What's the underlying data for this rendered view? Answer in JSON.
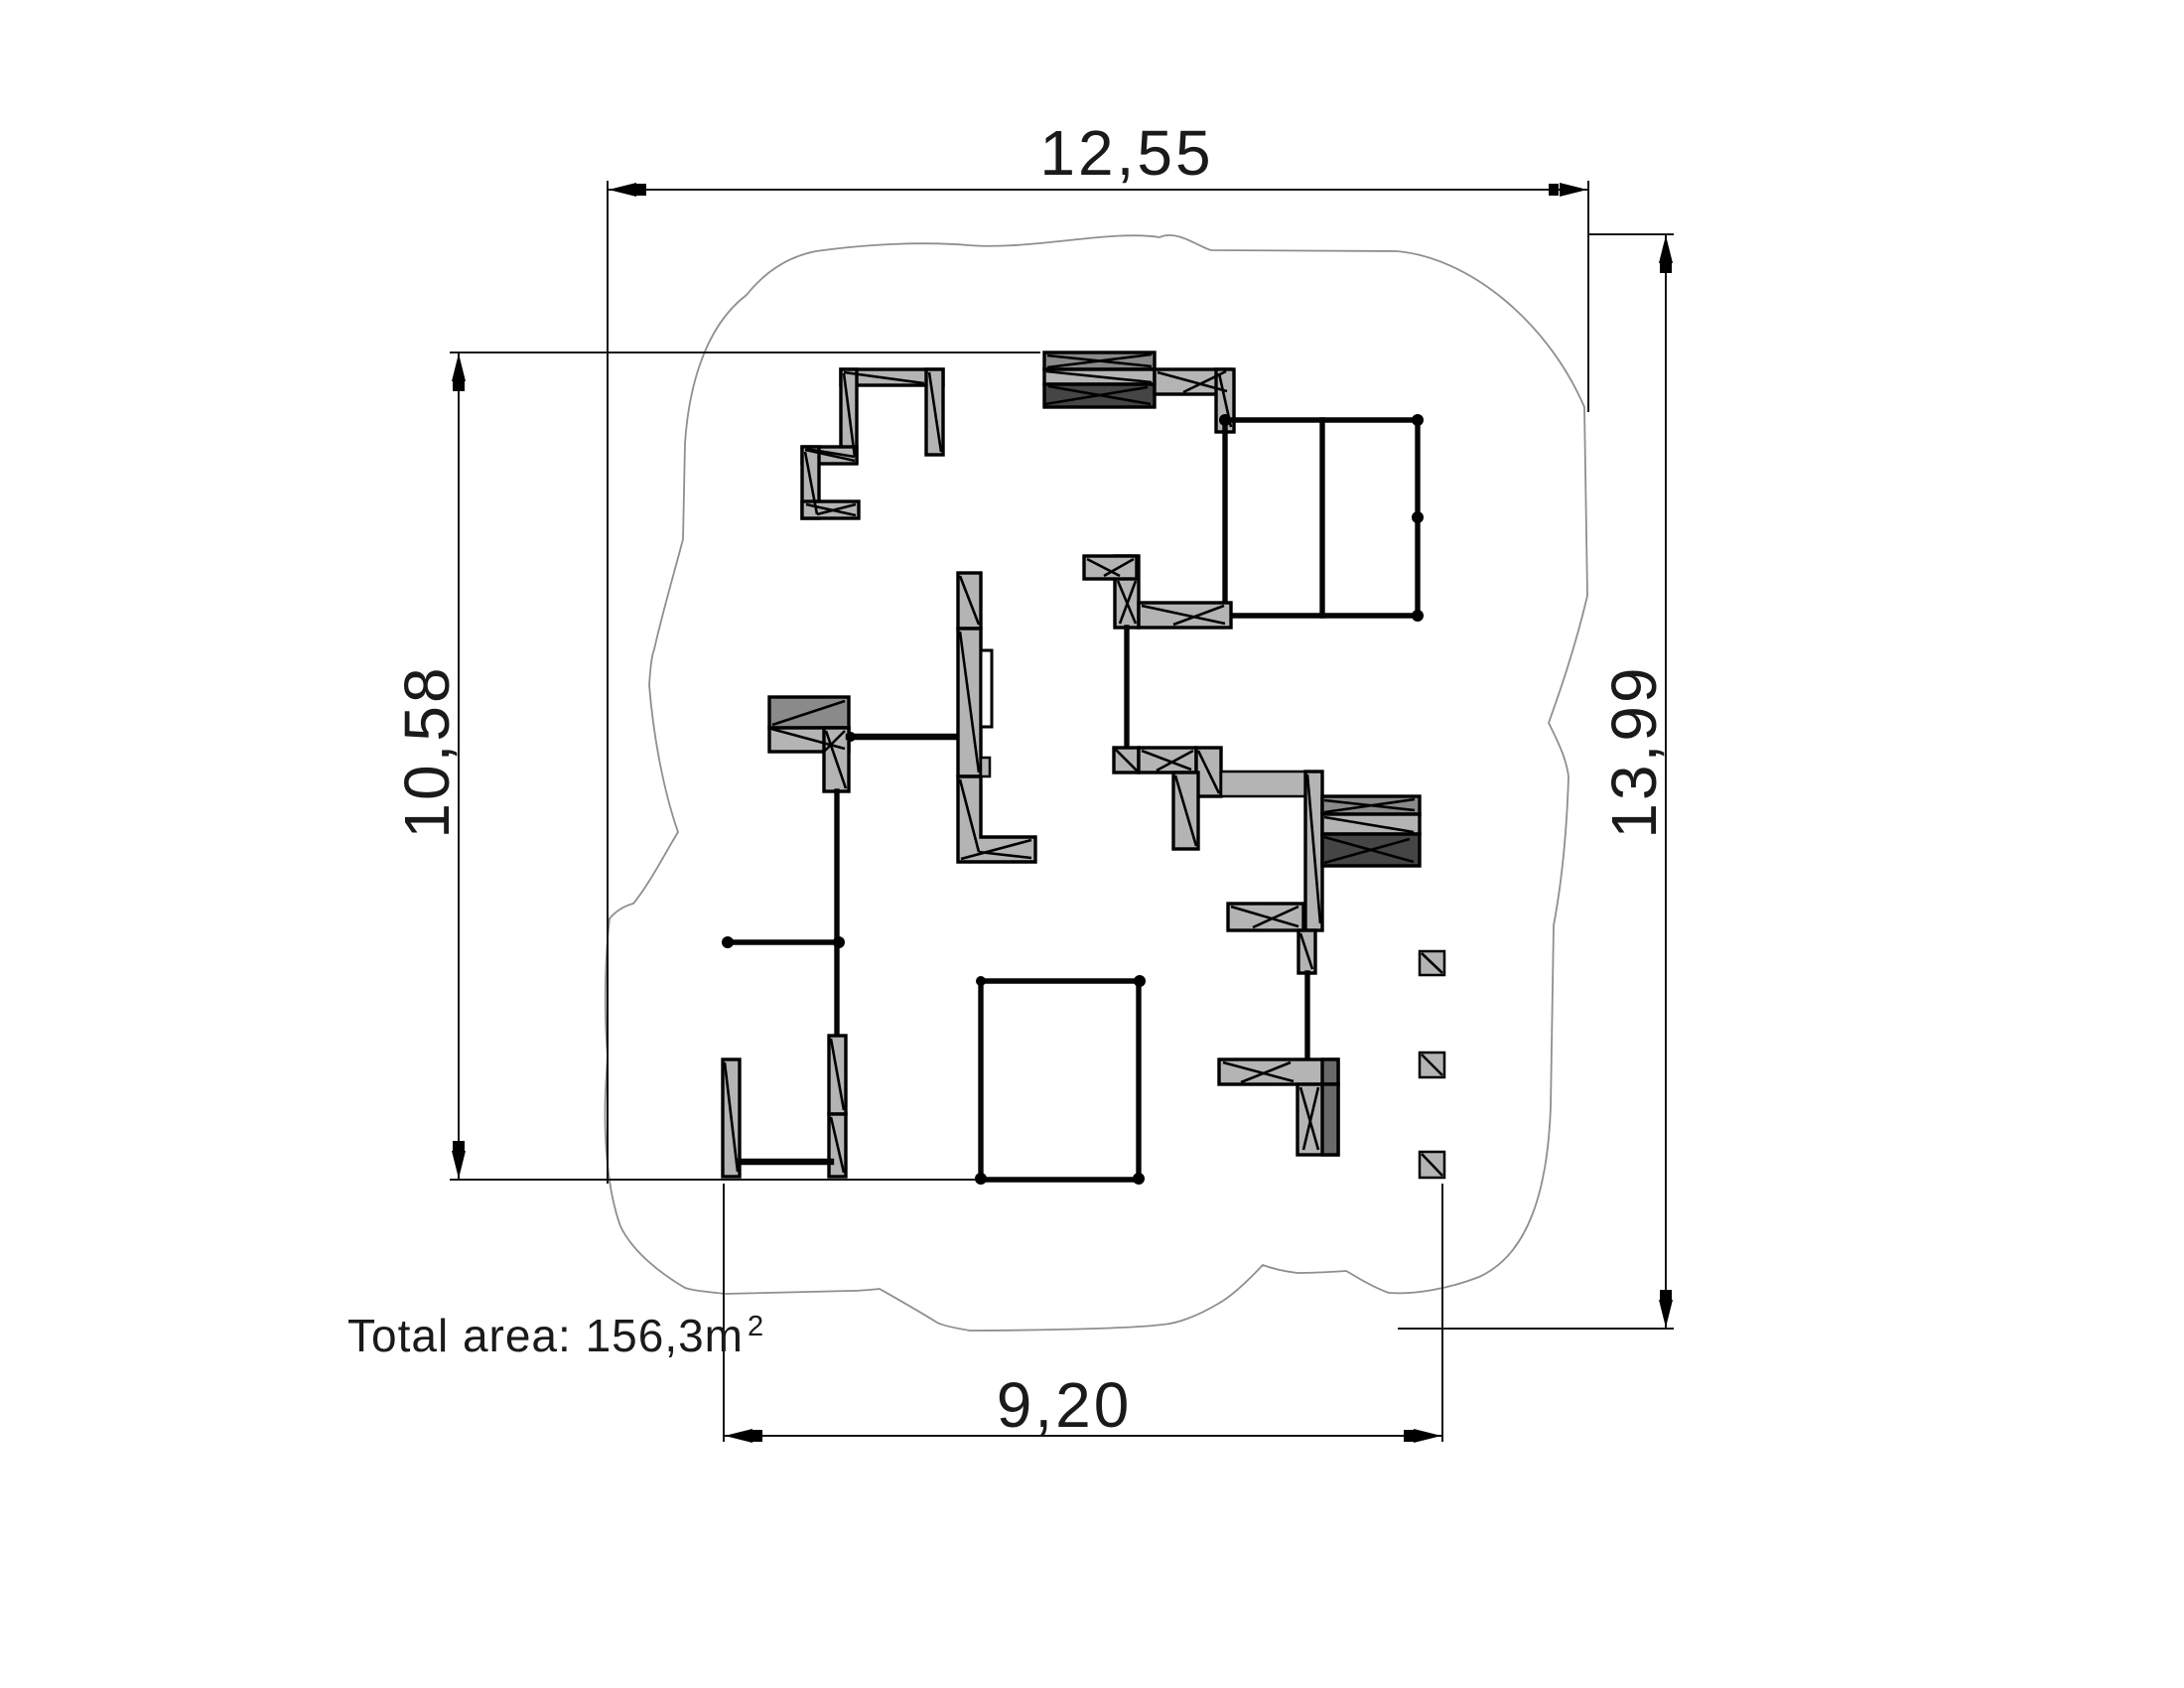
{
  "drawing": {
    "type": "floor-plan",
    "labels": {
      "dim_top": "12,55",
      "dim_left": "10,58",
      "dim_right": "13,99",
      "dim_bottom": "9,20",
      "total_area_prefix": "Total area: 156,3m",
      "total_area_exponent": "2"
    },
    "dimensions_meters": {
      "top_width": "12,55",
      "left_height": "10,58",
      "right_height": "13,99",
      "bottom_width": "9,20",
      "total_area_m2": "156,3"
    },
    "colors": {
      "background": "#ffffff",
      "wall_fill": "#b4b4b4",
      "wall_fill_medium": "#8a8a8a",
      "wall_fill_dark": "#454545",
      "wall_fill_middark": "#6a6a6a",
      "line": "#000000",
      "dimension_line": "#141414",
      "roof_outline": "#8f8f8f",
      "text": "#1a1a1a"
    }
  }
}
